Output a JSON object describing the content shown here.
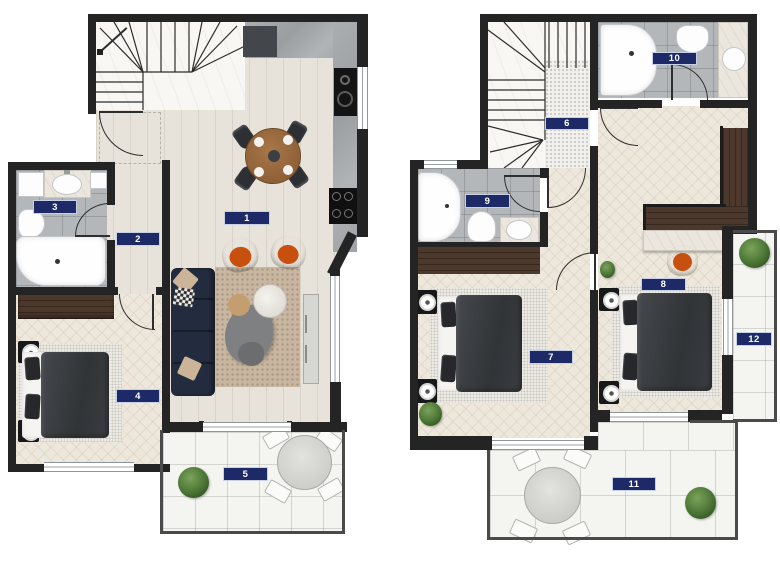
{
  "rooms": [
    "1",
    "2",
    "3",
    "4",
    "5",
    "6",
    "7",
    "8",
    "9",
    "10",
    "11",
    "12"
  ],
  "colors": {
    "badge_bg": "#1d2a67",
    "badge_border": "#c8d1e3",
    "badge_text": "#ffffff",
    "wall": "#242424",
    "accent_orange": "#e0611f"
  }
}
